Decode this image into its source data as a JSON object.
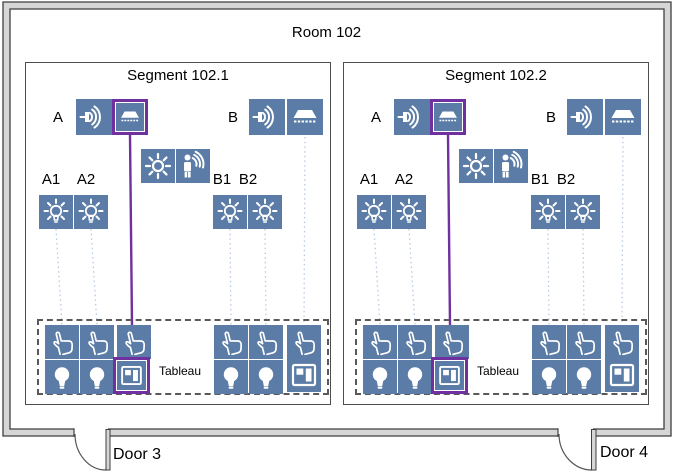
{
  "room": {
    "title": "Room 102"
  },
  "segments": [
    {
      "title": "Segment 102.1",
      "group_a_label": "A",
      "group_b_label": "B",
      "lamp_a1_label": "A1",
      "lamp_a2_label": "A2",
      "lamp_b1_label": "B1",
      "lamp_b2_label": "B2",
      "tableau_label": "Tableau"
    },
    {
      "title": "Segment 102.2",
      "group_a_label": "A",
      "group_b_label": "B",
      "lamp_a1_label": "A1",
      "lamp_a2_label": "A2",
      "lamp_b1_label": "B1",
      "lamp_b2_label": "B2",
      "tableau_label": "Tableau"
    }
  ],
  "doors": [
    {
      "label": "Door 3"
    },
    {
      "label": "Door 4"
    }
  ],
  "icons": [
    "sounder-icon",
    "ceiling-luminaire-icon",
    "brightness-sensor-icon",
    "presence-detector-icon",
    "shining-lamp-icon",
    "push-button-icon",
    "bulb-icon",
    "window-panes-icon"
  ],
  "colors": {
    "device_blue": "#5b7ca6",
    "highlight_purple": "#7030a0",
    "connector_blue": "#b7c9e2",
    "wall_fill": "#d6d6d6",
    "wall_stroke": "#3f3f3f",
    "dashed_gray": "#595959",
    "segment_border": "#4d4d4d"
  }
}
